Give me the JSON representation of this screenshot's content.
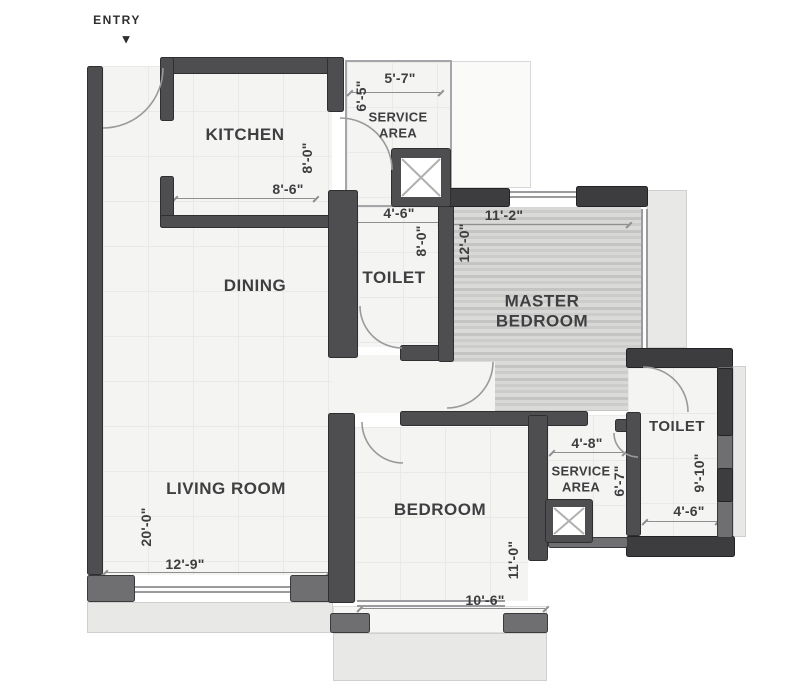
{
  "title": "Apartment floor plan",
  "entry": {
    "label": "ENTRY",
    "arrow": "▼"
  },
  "rooms": {
    "kitchen": {
      "label": "KITCHEN",
      "width": "8'-6\"",
      "depth": "8'-0\""
    },
    "service_top": {
      "label": "SERVICE\nAREA",
      "width": "5'-7\"",
      "depth": "6'-5\""
    },
    "toilet": {
      "label": "TOILET",
      "width": "4'-6\"",
      "depth": "8'-0\""
    },
    "master_bedroom": {
      "label": "MASTER\nBEDROOM",
      "width": "11'-2\"",
      "depth": "12'-0\""
    },
    "dining": {
      "label": "DINING"
    },
    "living_room": {
      "label": "LIVING ROOM",
      "width": "12'-9\"",
      "depth": "20'-0\""
    },
    "bedroom": {
      "label": "BEDROOM",
      "width": "10'-6\"",
      "depth": "11'-0\""
    },
    "service_right": {
      "label": "SERVICE\nAREA",
      "width": "4'-8\"",
      "depth": "6'-7\""
    },
    "toilet_right": {
      "label": "TOILET",
      "width": "4'-6\"",
      "depth": "9'-10\""
    }
  },
  "colors": {
    "wall_dark": "#4e4e50",
    "wall_mid": "#6f6f72",
    "floor": "#f4f4f2",
    "wood_floor": "#cfcfcd",
    "exterior": "#e8e8e6",
    "text": "#3e3e40"
  }
}
